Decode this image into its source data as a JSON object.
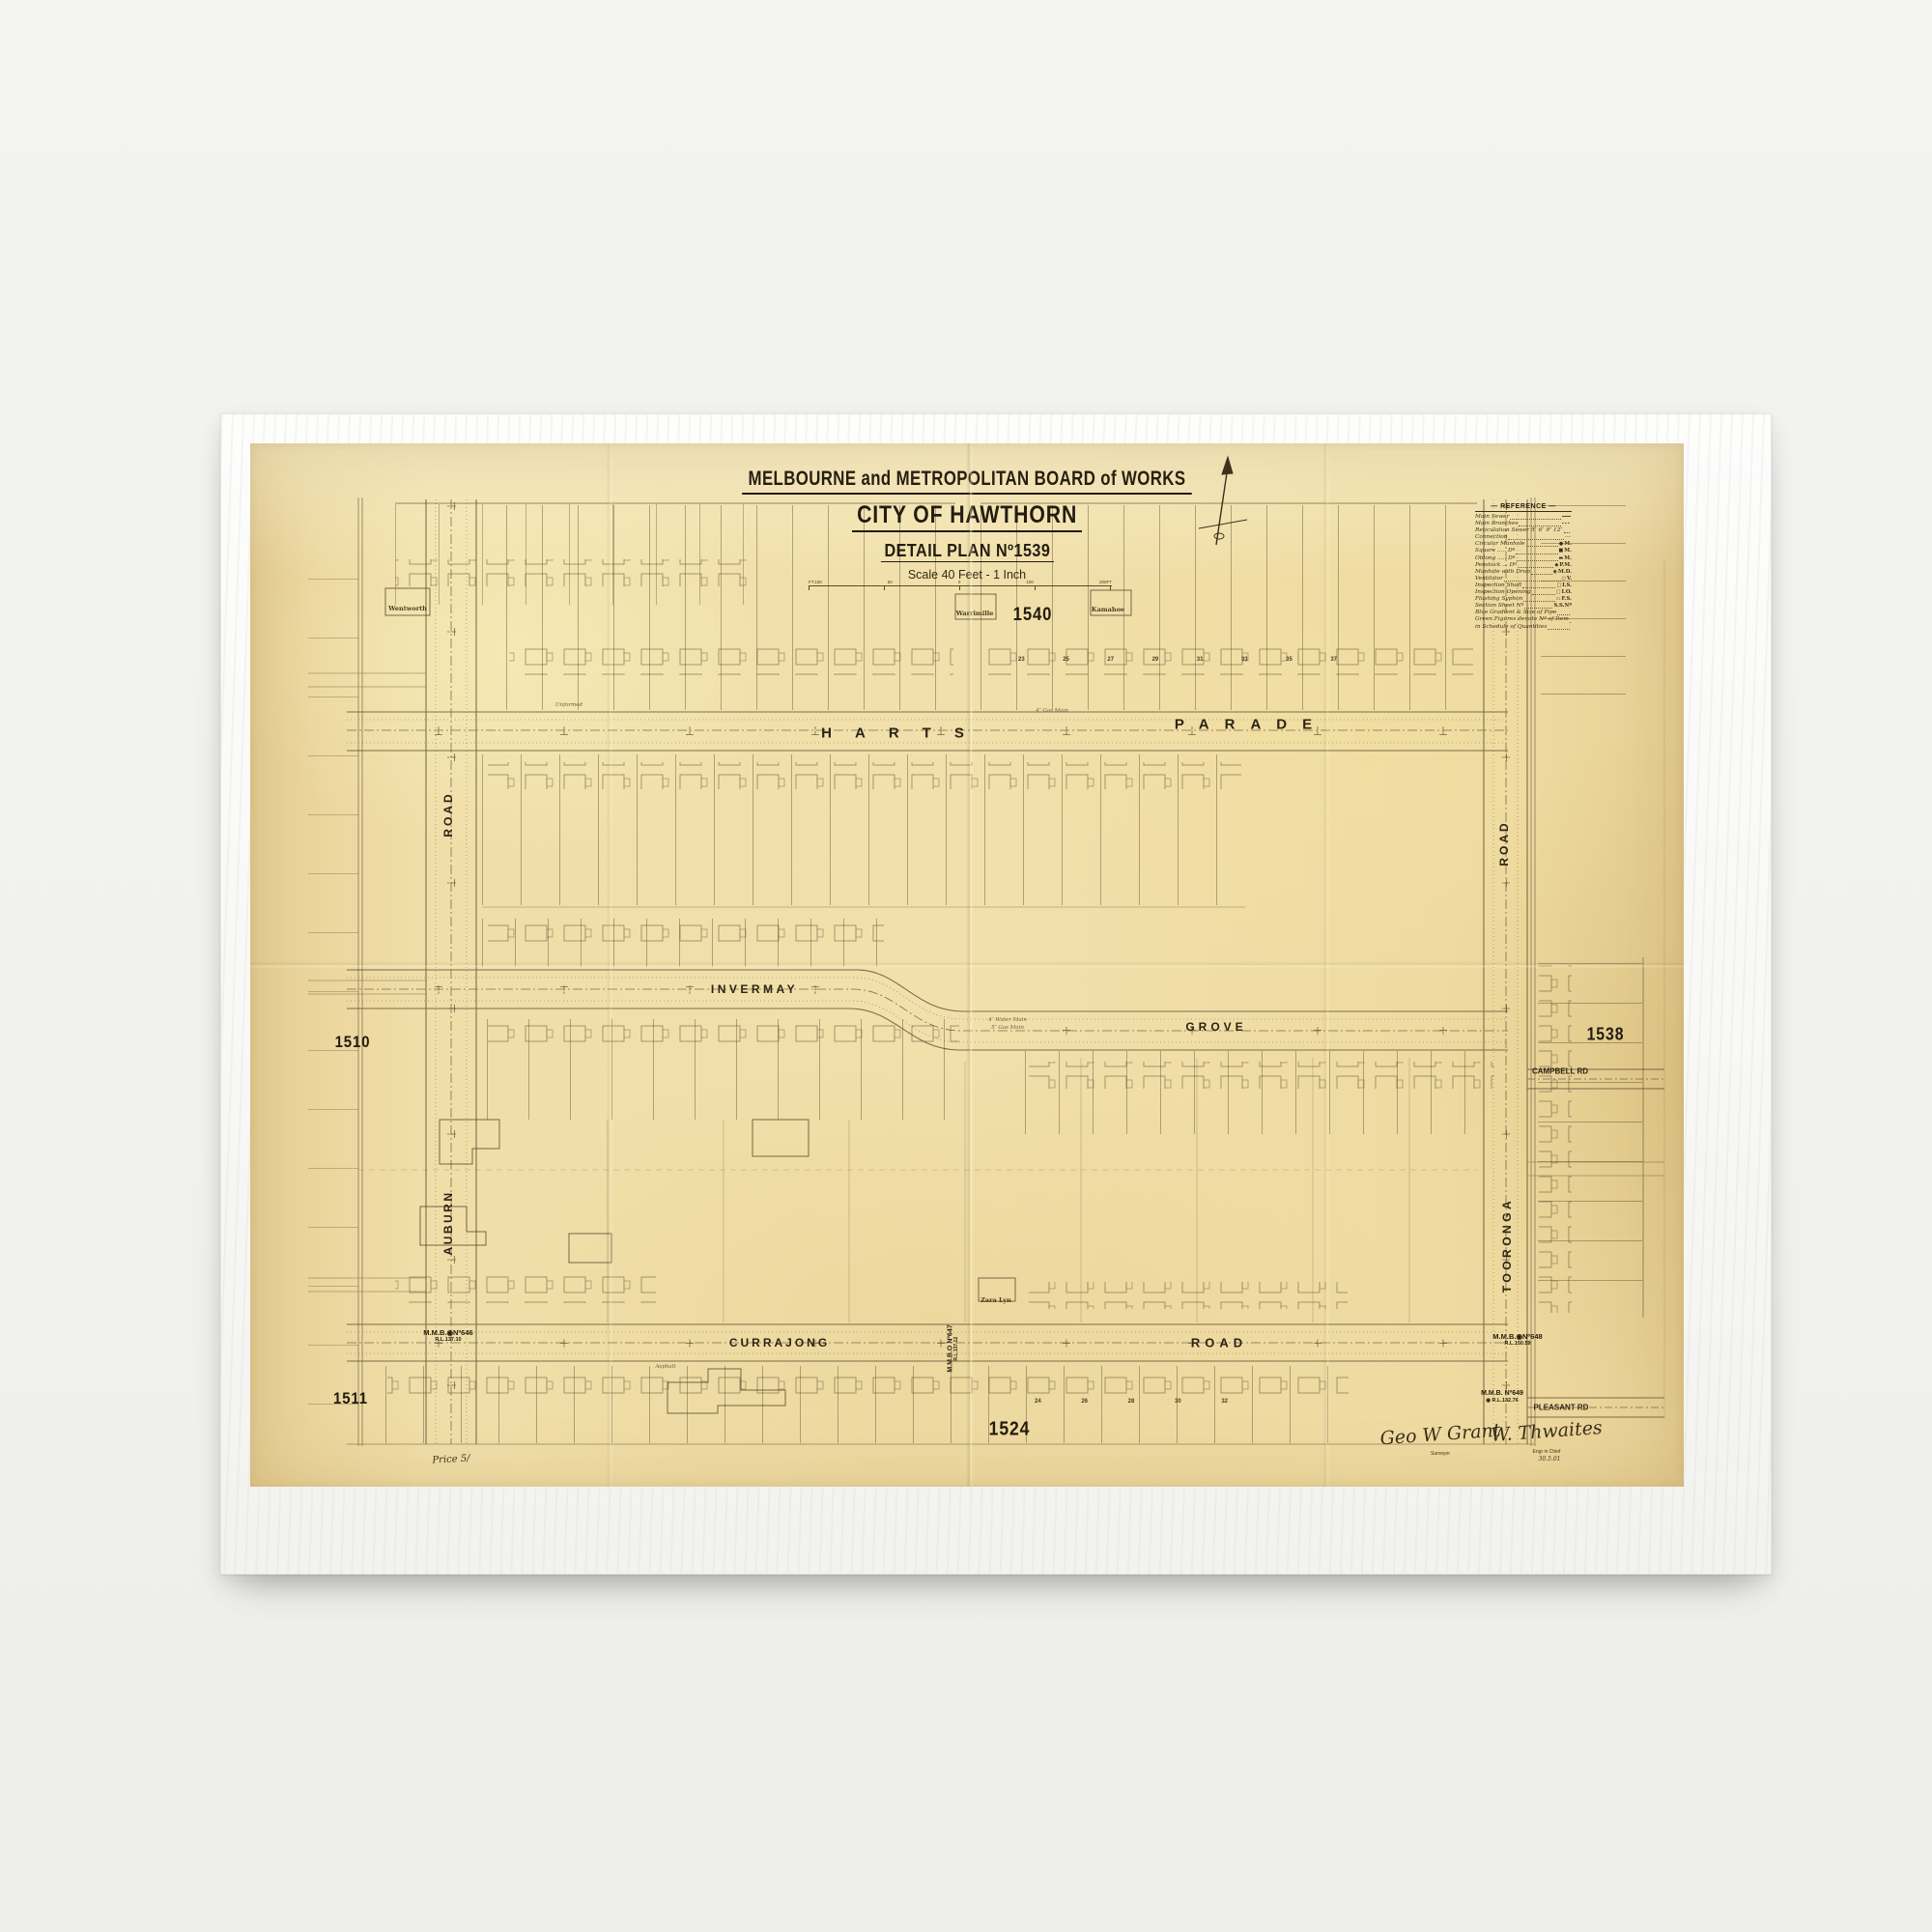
{
  "plan": {
    "board": "MELBOURNE and METROPOLITAN BOARD of WORKS",
    "city": "CITY OF HAWTHORN",
    "detail": "DETAIL PLAN Nº1539",
    "scale": "Scale 40 Feet - 1 Inch",
    "scale_ticks": [
      "FT.100",
      "50",
      "0",
      "100",
      "200FT"
    ]
  },
  "legend": {
    "title": "— REFERENCE —",
    "rows": [
      {
        "label": "Main Sewer",
        "sym": "━━━",
        "abbr": ""
      },
      {
        "label": "Main Branches",
        "sym": "╸╸╸",
        "abbr": ""
      },
      {
        "label": "Reticulation Sewer 5″ 6″ 9″ 12″",
        "sym": "",
        "abbr": ""
      },
      {
        "label": "Connection",
        "sym": "┄┄",
        "abbr": ""
      },
      {
        "label": "Circular Manhole",
        "sym": "●",
        "abbr": "M."
      },
      {
        "label": "Square ..... Dº",
        "sym": "■",
        "abbr": "M."
      },
      {
        "label": "Oblong ..... Dº",
        "sym": "▬",
        "abbr": "M."
      },
      {
        "label": "Penstock ... Dº",
        "sym": "◆",
        "abbr": "P.M."
      },
      {
        "label": "Manhole with Drop",
        "sym": "◉",
        "abbr": "M.D."
      },
      {
        "label": "Ventilator",
        "sym": "○",
        "abbr": "V."
      },
      {
        "label": "Inspection Shaft",
        "sym": "□",
        "abbr": "I.S."
      },
      {
        "label": "Inspection Opening",
        "sym": "▢",
        "abbr": "I.O."
      },
      {
        "label": "Flushing Syphon",
        "sym": "▭",
        "abbr": "F.S."
      },
      {
        "label": "Section Sheet Nº",
        "sym": "",
        "abbr": "S.S.Nº"
      },
      {
        "label": "Blue Gradient & Size of Pipe",
        "sym": "",
        "abbr": ""
      },
      {
        "label": "Green Figures denote Nº of Item",
        "sym": "",
        "abbr": ""
      },
      {
        "label": "in Schedule of Quantities",
        "sym": "",
        "abbr": ""
      }
    ]
  },
  "adjoining": {
    "top": "1540",
    "right": "1538",
    "left_upper": "1510",
    "left_lower": "1511",
    "bottom": "1524"
  },
  "streets": {
    "harts": "HARTS",
    "parade": "PARADE",
    "invermay": "INVERMAY",
    "grove": "GROVE",
    "currajong": "CURRAJONG",
    "currajong_road": "ROAD",
    "auburn": "AUBURN",
    "auburn_road": "ROAD",
    "tooronga": "TOORONGA",
    "tooronga_road": "ROAD",
    "campbell": "CAMPBELL RD",
    "pleasant": "PLEASANT RD"
  },
  "houses": {
    "h1": "Wentworth",
    "h2": "Warrimille",
    "h3": "Kamahoe",
    "h4": "Zara Lyn"
  },
  "micro": {
    "m1": "Unformed",
    "m2": "Asphalt",
    "m3": "4″ Gas Main",
    "m4": "4″ Water Main",
    "m5": "5″ Gas Main"
  },
  "lot_numbers_top": [
    "23",
    "25",
    "27",
    "29",
    "31",
    "33",
    "35",
    "37"
  ],
  "lot_numbers_bottom": [
    "24",
    "26",
    "28",
    "30",
    "32"
  ],
  "benchmarks": {
    "b646": {
      "name": "M.M.B.◉Nº646",
      "rl": "R.L.137.10"
    },
    "b647": {
      "name": "M.M.B.O Nº647",
      "rl": "R.L.137.12"
    },
    "b648": {
      "name": "M.M.B.◉Nº648",
      "rl": "R.L.150.59"
    },
    "b649": {
      "name": "M.M.B. Nº649",
      "rl": "◉ R.L.132.76"
    }
  },
  "imprint": {
    "surveyor_sig": "Geo W Grant",
    "surveyor_title": "Surveyor",
    "engineer_sig": "W. Thwaites",
    "engineer_title": "Engr in Chief",
    "date": "30.5.01",
    "price": "Price 5/"
  }
}
